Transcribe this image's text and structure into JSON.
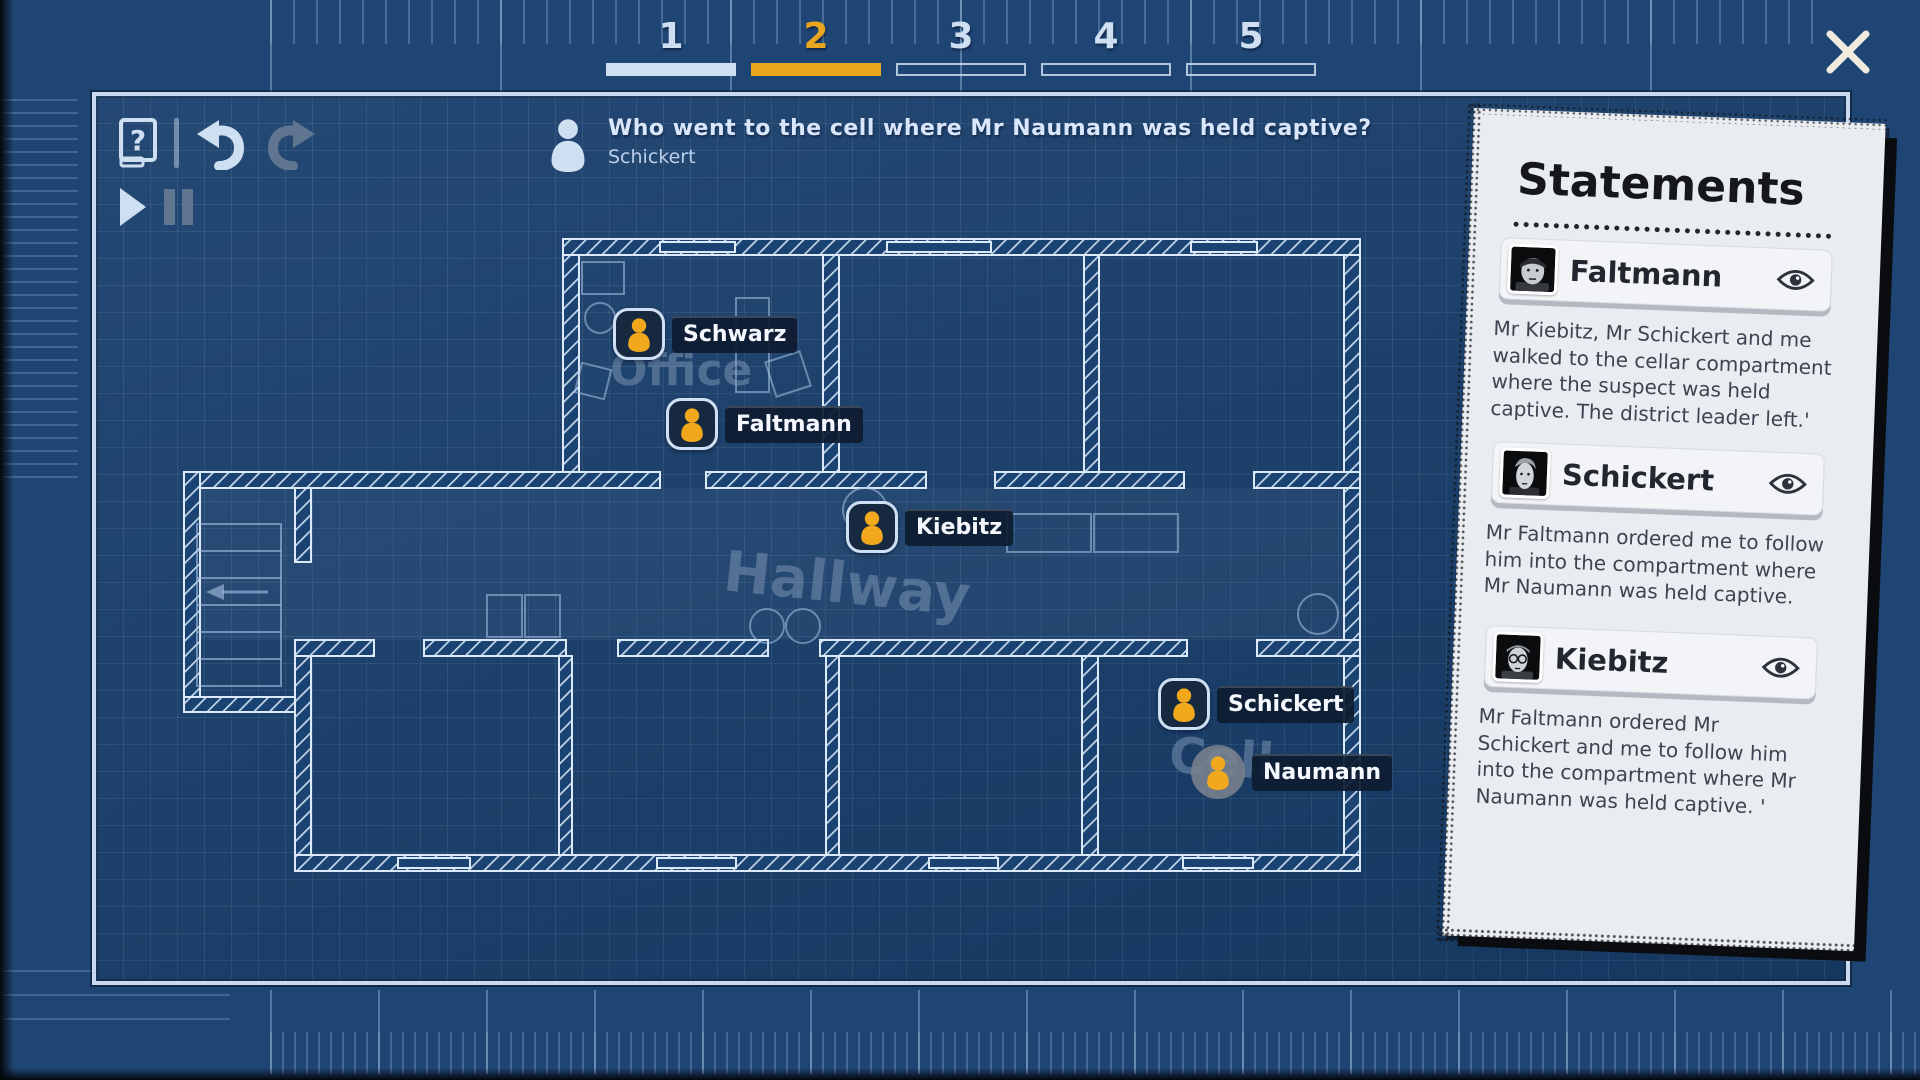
{
  "header": {
    "tabs": [
      {
        "label": "1",
        "state": "complete"
      },
      {
        "label": "2",
        "state": "active"
      },
      {
        "label": "3",
        "state": "incomplete"
      },
      {
        "label": "4",
        "state": "incomplete"
      },
      {
        "label": "5",
        "state": "incomplete"
      }
    ]
  },
  "icons": {
    "help": "book-question-icon",
    "undo": "undo-arrow-icon",
    "redo": "redo-arrow-icon",
    "play": "play-icon",
    "pause": "pause-icon",
    "close": "close-x-icon",
    "character": "person-icon",
    "reveal": "eye-icon"
  },
  "question": {
    "text": "Who went to the cell where Mr Naumann was held captive?",
    "answer": "Schickert"
  },
  "map": {
    "room_labels": [
      {
        "label": "Office"
      },
      {
        "label": "Hallway"
      },
      {
        "label": "Cell"
      }
    ],
    "characters": [
      {
        "name": "Schwarz",
        "room": "Office",
        "marker": "boxed"
      },
      {
        "name": "Faltmann",
        "room": "Office",
        "marker": "boxed"
      },
      {
        "name": "Kiebitz",
        "room": "Hallway",
        "marker": "boxed"
      },
      {
        "name": "Schickert",
        "room": "Cell",
        "marker": "boxed"
      },
      {
        "name": "Naumann",
        "room": "Cell",
        "marker": "gray-circle"
      }
    ]
  },
  "statements": {
    "title": "Statements",
    "items": [
      {
        "name": "Faltmann",
        "text": "Mr Kiebitz, Mr Schickert and me walked to the cellar compartment where the suspect was held captive. The district leader left.'"
      },
      {
        "name": "Schickert",
        "text": "Mr Faltmann ordered me to follow him into the compartment where Mr Naumann was held captive."
      },
      {
        "name": "Kiebitz",
        "text": "Mr Faltmann ordered Mr Schickert and me to follow him into the compartment where Mr Naumann was held captive. '"
      }
    ]
  },
  "colors": {
    "accent_orange": "#e9a61f",
    "blueprint_bg": "#183f6c",
    "wall_light": "#dce9f8",
    "paper": "#e9ecf0",
    "marker_person": "#f2a81d"
  }
}
